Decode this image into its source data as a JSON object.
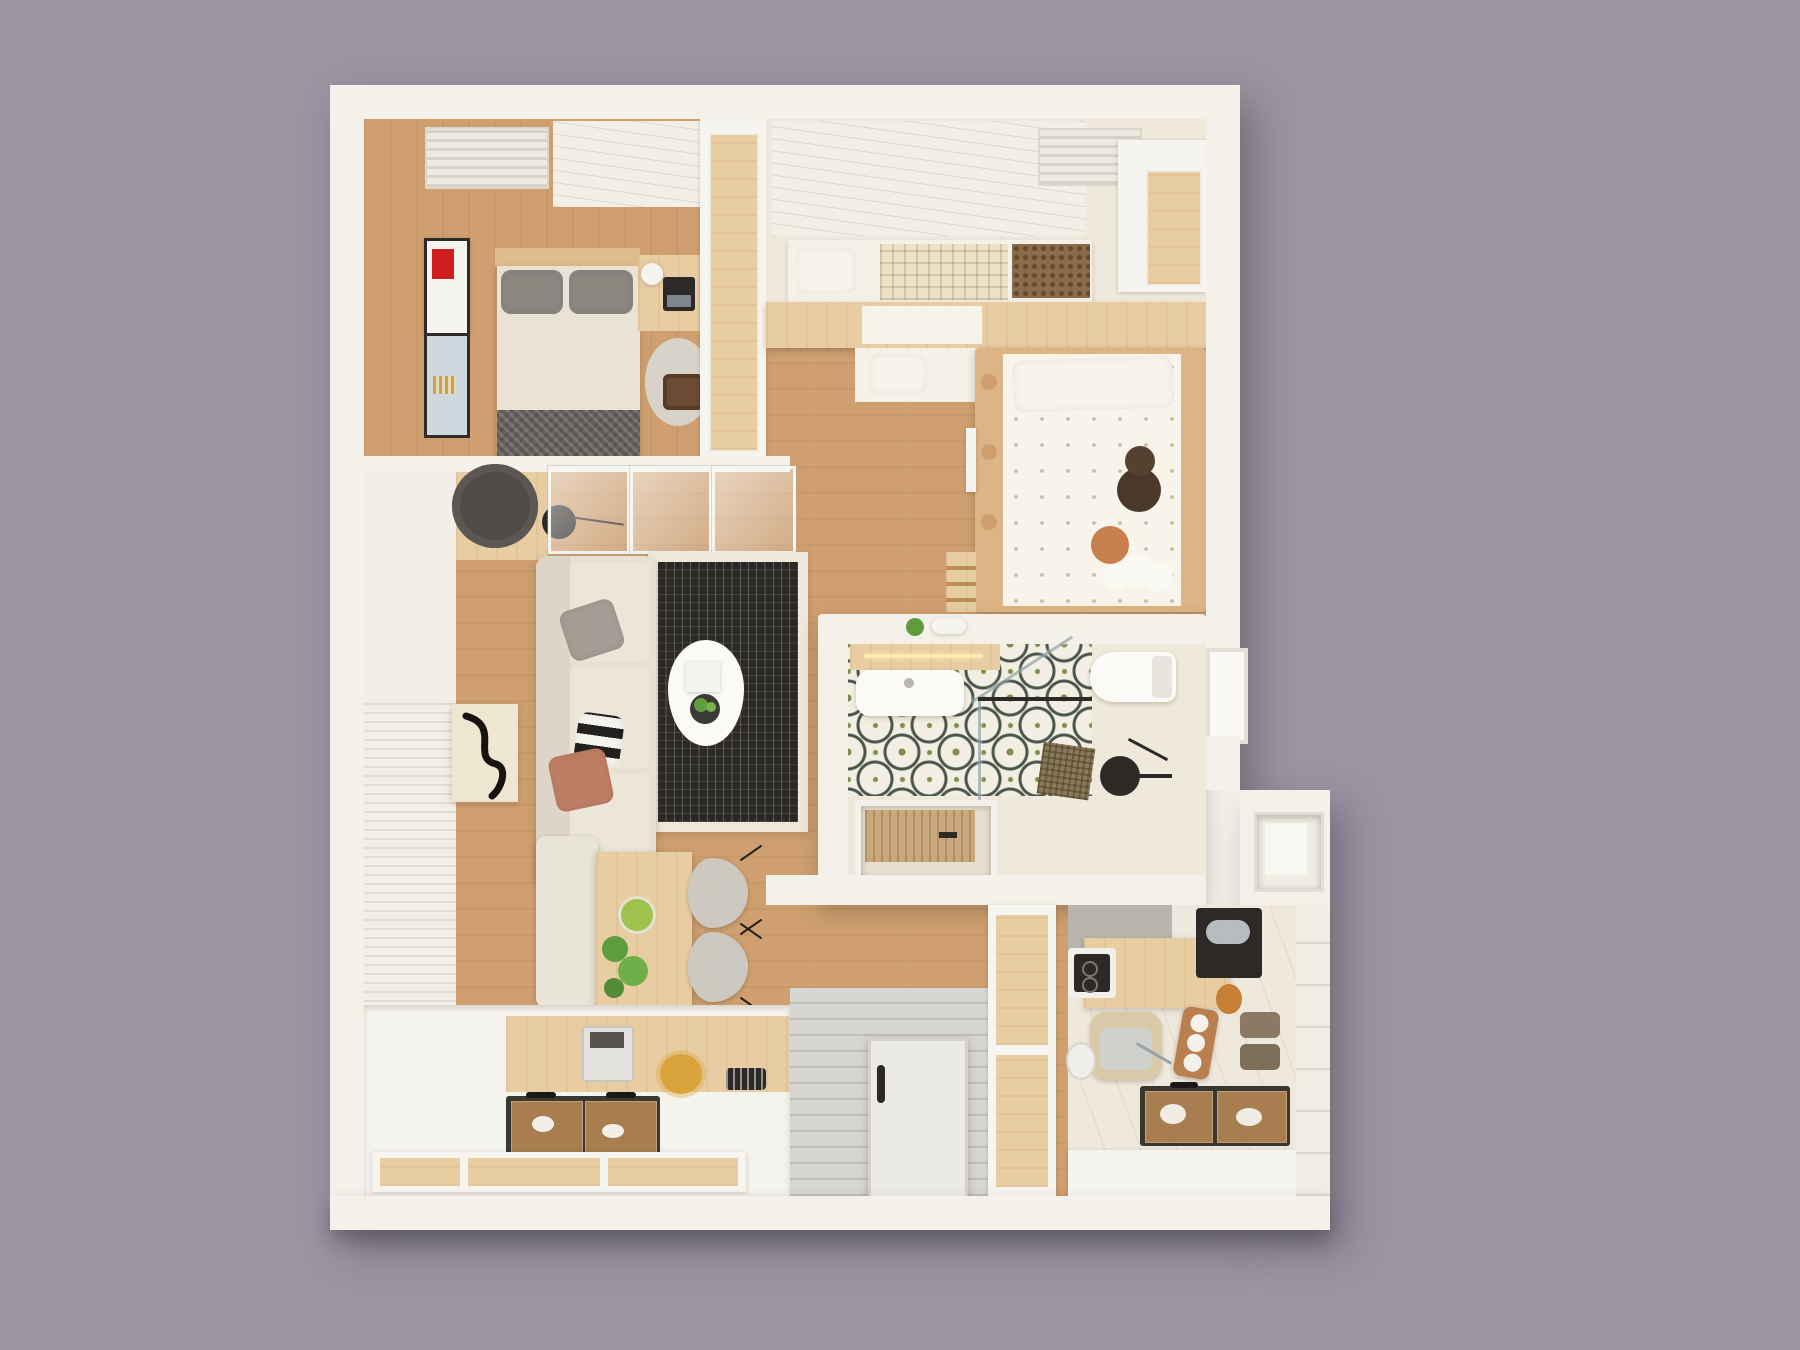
{
  "scene": {
    "title": "Top-down 3D render of a small apartment floor plan",
    "view": "overhead dollhouse render, no visible text",
    "background_label": "plain mauve-gray backdrop"
  },
  "palette": {
    "bg": "#9a95a1",
    "wall": "#f4f1ea",
    "wall_shade": "#e6e2d8",
    "wood": "#cf9f6f",
    "wood_light": "#e0bb8d",
    "counter_wood": "#e8cda2",
    "cream": "#efe9dc",
    "marble": "#efe8dc",
    "entry_floor": "#d8d6d2",
    "tile_base": "#f2eee3",
    "tile_green": "#7d8f4a",
    "tile_line": "#4a554d",
    "rug": "#efe9dc",
    "rug_dot": "#2b2926",
    "sofa": "#e7e1d4",
    "accent_red": "#cf1d1d",
    "glass_amber": "rgba(205,150,90,0.75)",
    "fixture_black": "#2c2926",
    "kid_wood": "#dcb486",
    "gray_patch": "#b9b4ae",
    "plant_green": "#5f9c3f"
  },
  "rooms": [
    {
      "id": "master-bedroom",
      "label": "Master bedroom",
      "furniture": [
        "double bed with gray pillows",
        "cream duvet",
        "dark knit throw",
        "wood headboard",
        "desk with laptop and lamp",
        "round area rug",
        "wood stool",
        "two framed artworks",
        "ceiling vent",
        "tall wardrobe"
      ],
      "pillow_count": 2,
      "artwork_count": 2
    },
    {
      "id": "bedroom-2",
      "label": "Second bedroom / loft",
      "furniture": [
        "lower bed with white pillow",
        "checkered blanket",
        "rattan footboard",
        "wood loft platform",
        "built-in wardrobe",
        "ceiling panel with vent"
      ]
    },
    {
      "id": "kids-room",
      "label": "Kids room",
      "furniture": [
        "wood bed frame with round cutouts",
        "bear-print bedding",
        "white pillow",
        "teddy bear",
        "orange pompom cushion",
        "cloud cushion",
        "loft ladder",
        "wall shelf"
      ]
    },
    {
      "id": "living-room",
      "label": "Living room",
      "furniture": [
        "three-seat sofa",
        "gray cushion",
        "striped cushion",
        "copper cushion",
        "dot-grid rug",
        "egg-shaped coffee table with plant",
        "floor lamp",
        "round planter",
        "wood sideboard",
        "glass sliding partition",
        "abstract art panel",
        "slatted wall paneling"
      ],
      "sofa_seats": 3
    },
    {
      "id": "dining-area",
      "label": "Dining area",
      "furniture": [
        "wood dining table",
        "upholstered bench",
        "two gray chairs",
        "bowl of green apples",
        "trailing plant"
      ],
      "chair_count": 2
    },
    {
      "id": "tatami-platform",
      "label": "Tatami storage platform",
      "furniture": [
        "glass-top sunken storage",
        "coffee machine",
        "dried yellow flowers",
        "digital clock",
        "wood drawer fronts"
      ]
    },
    {
      "id": "entry",
      "label": "Entry corridor",
      "furniture": [
        "gray entry flooring",
        "front door with black handle"
      ]
    },
    {
      "id": "bathroom",
      "label": "Bathroom pod",
      "furniture": [
        "vanity with basin and light strip",
        "toilet",
        "window",
        "walk-in glass shower",
        "black shower set",
        "sunken soaking tub with wood slats",
        "brown shower mat",
        "green quatrefoil tile floor"
      ]
    },
    {
      "id": "kitchen",
      "label": "Kitchen",
      "furniture": [
        "induction cooktop",
        "wood counter slab",
        "beige sink with chrome faucet",
        "black coffee machine",
        "amber jar",
        "wood tray with cups",
        "storage boxes",
        "glass-top sunken storage",
        "sliding wood door"
      ],
      "cup_count": 3
    },
    {
      "id": "balcony",
      "label": "Balcony / skylight bay",
      "furniture": [
        "recessed skylight panel"
      ]
    }
  ]
}
